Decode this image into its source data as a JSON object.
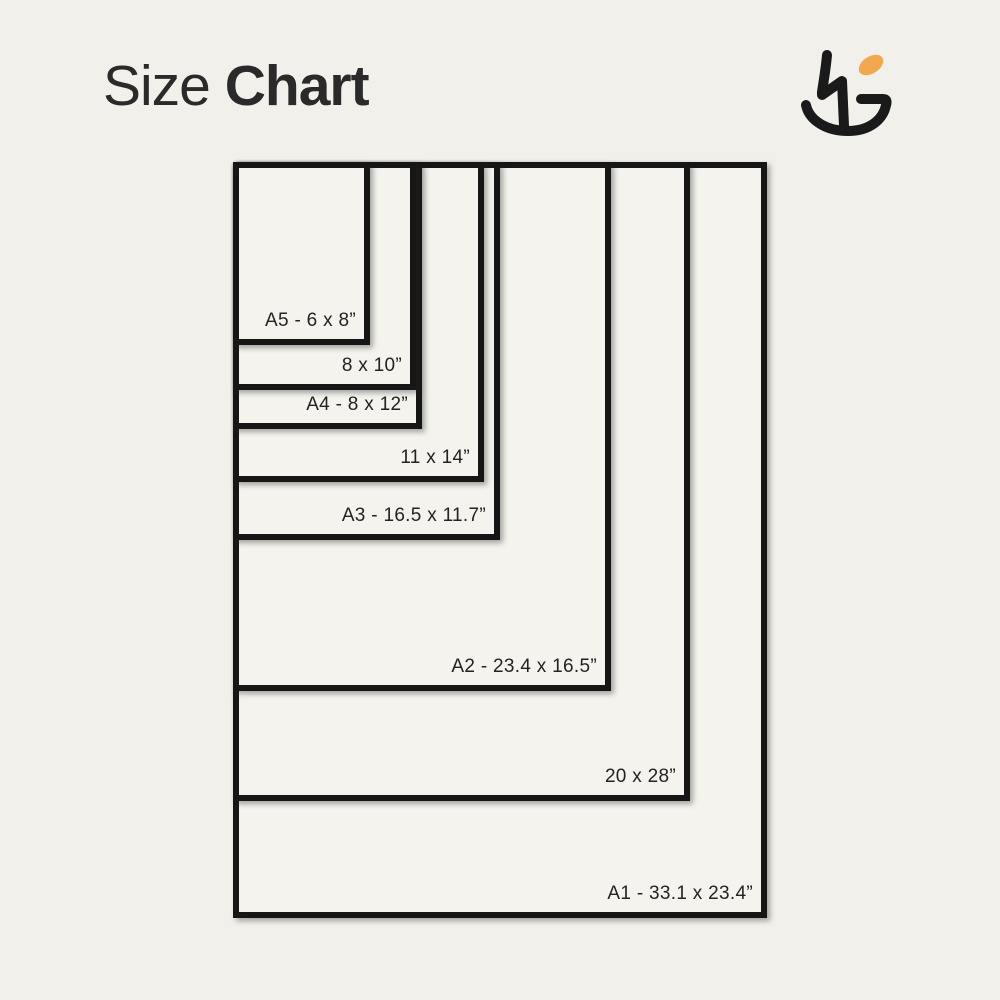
{
  "background": "#f1f0ea",
  "title": {
    "regular": "Size",
    "bold": "Chart"
  },
  "logo": {
    "ink": "#1a1a1a",
    "accent": "#F2A84F"
  },
  "chart_data": {
    "type": "nested-rectangles-size-chart",
    "title": "Size Chart",
    "unit": "inches",
    "px_per_inch": 22.83,
    "anchor": {
      "left": 233,
      "top": 162
    },
    "border_px": 6,
    "paper_fill": "#f4f3ee",
    "line_color": "#161616",
    "legend_position": "inside-bottom-right-of-each-rectangle",
    "sizes": [
      {
        "id": "a1",
        "label": "A1 - 33.1 x 23.4”",
        "width_in": 23.4,
        "height_in": 33.1,
        "w_px": 534,
        "h_px": 756
      },
      {
        "id": "20x28",
        "label": "20 x 28”",
        "width_in": 20,
        "height_in": 28,
        "w_px": 457,
        "h_px": 639
      },
      {
        "id": "a2",
        "label": "A2 - 23.4 x 16.5”",
        "width_in": 16.5,
        "height_in": 23.4,
        "w_px": 378,
        "h_px": 529
      },
      {
        "id": "a3",
        "label": "A3 - 16.5 x 11.7”",
        "width_in": 11.7,
        "height_in": 16.5,
        "w_px": 267,
        "h_px": 378
      },
      {
        "id": "11x14",
        "label": "11 x 14”",
        "width_in": 11,
        "height_in": 14,
        "w_px": 251,
        "h_px": 320
      },
      {
        "id": "a4",
        "label": "A4 - 8 x 12”",
        "width_in": 8.3,
        "height_in": 11.7,
        "w_px": 189,
        "h_px": 267
      },
      {
        "id": "8x10",
        "label": "8 x 10”",
        "width_in": 8,
        "height_in": 10,
        "w_px": 183,
        "h_px": 228
      },
      {
        "id": "a5",
        "label": "A5 - 6 x 8”",
        "width_in": 6,
        "height_in": 8,
        "w_px": 137,
        "h_px": 183
      }
    ]
  }
}
